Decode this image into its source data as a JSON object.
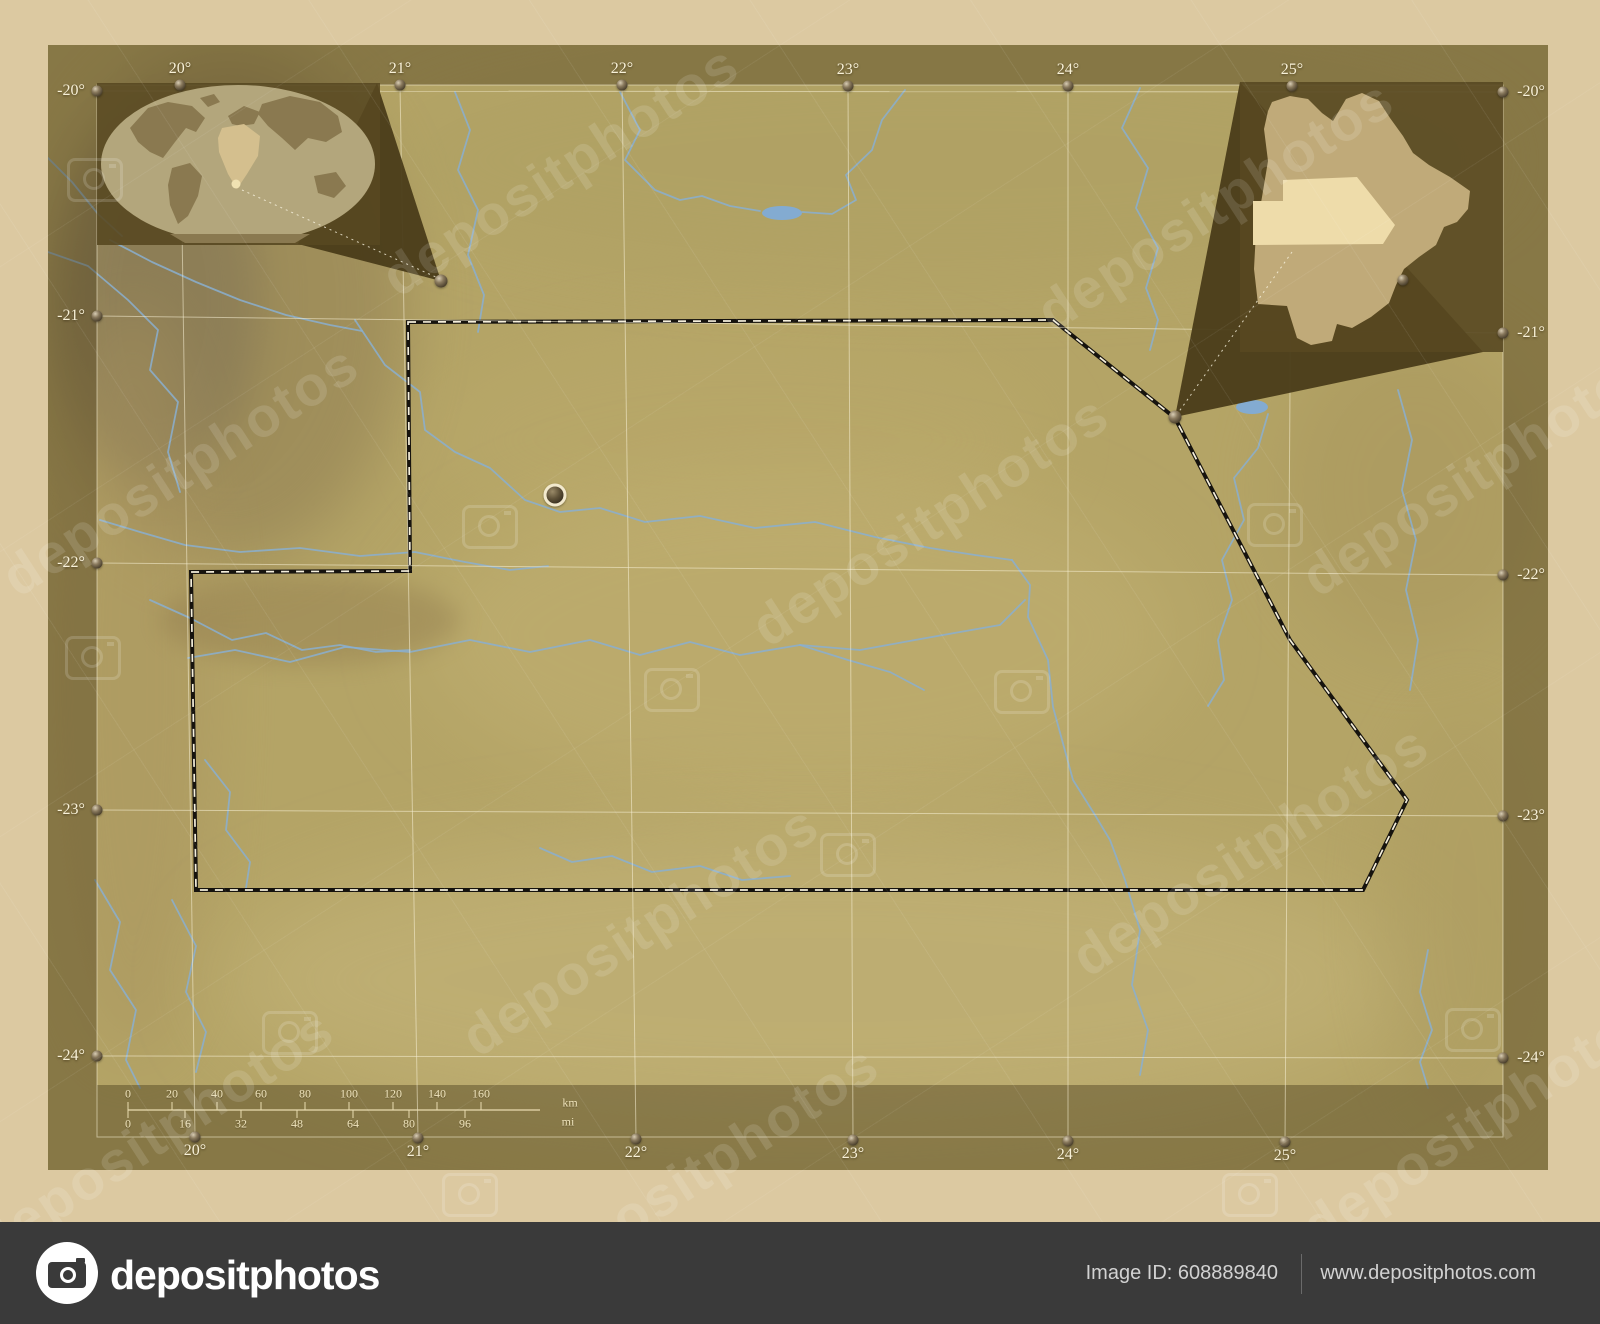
{
  "page": {
    "background": "#dcc9a1"
  },
  "footer": {
    "logo_text": "depositphotos",
    "image_id": "Image ID: 608889840",
    "website": "www.depositphotos.com"
  },
  "watermark": {
    "text": "depositphotos",
    "text_instances": [
      [
        560,
        170
      ],
      [
        1215,
        205
      ],
      [
        180,
        470
      ],
      [
        930,
        520
      ],
      [
        1480,
        470
      ],
      [
        640,
        930
      ],
      [
        1250,
        850
      ],
      [
        155,
        1135
      ],
      [
        700,
        1170
      ],
      [
        1480,
        1120
      ]
    ],
    "icon_instances": [
      [
        95,
        180
      ],
      [
        490,
        527
      ],
      [
        1275,
        525
      ],
      [
        93,
        658
      ],
      [
        672,
        690
      ],
      [
        1022,
        692
      ],
      [
        848,
        855
      ],
      [
        290,
        1033
      ],
      [
        1473,
        1030
      ],
      [
        470,
        1195
      ],
      [
        1250,
        1195
      ]
    ]
  },
  "axes": {
    "top": [
      {
        "label": "20°",
        "x": 180,
        "y": 85
      },
      {
        "label": "21°",
        "x": 400,
        "y": 85
      },
      {
        "label": "22°",
        "x": 622,
        "y": 85
      },
      {
        "label": "23°",
        "x": 848,
        "y": 86
      },
      {
        "label": "24°",
        "x": 1068,
        "y": 86
      },
      {
        "label": "25°",
        "x": 1292,
        "y": 86
      }
    ],
    "bottom": [
      {
        "label": "20°",
        "x": 195,
        "y": 1137
      },
      {
        "label": "21°",
        "x": 418,
        "y": 1138
      },
      {
        "label": "22°",
        "x": 636,
        "y": 1139
      },
      {
        "label": "23°",
        "x": 853,
        "y": 1140
      },
      {
        "label": "24°",
        "x": 1068,
        "y": 1141
      },
      {
        "label": "25°",
        "x": 1285,
        "y": 1142
      }
    ],
    "left": [
      {
        "label": "-20°",
        "x": 97,
        "y": 91
      },
      {
        "label": "-21°",
        "x": 97,
        "y": 316
      },
      {
        "label": "-22°",
        "x": 97,
        "y": 563
      },
      {
        "label": "-23°",
        "x": 97,
        "y": 810
      },
      {
        "label": "-24°",
        "x": 97,
        "y": 1056
      }
    ],
    "right": [
      {
        "label": "-20°",
        "x": 1503,
        "y": 92
      },
      {
        "label": "-21°",
        "x": 1503,
        "y": 333
      },
      {
        "label": "-22°",
        "x": 1503,
        "y": 575
      },
      {
        "label": "-23°",
        "x": 1503,
        "y": 816
      },
      {
        "label": "-24°",
        "x": 1503,
        "y": 1058
      }
    ]
  },
  "scalebar": {
    "km": {
      "unit": "km",
      "line_y": 1110,
      "line_x1": 128,
      "line_x2": 540,
      "label_y": 1094,
      "unit_x": 570,
      "unit_y": 1103,
      "ticks": [
        {
          "label": "0",
          "x": 128
        },
        {
          "label": "20",
          "x": 172
        },
        {
          "label": "40",
          "x": 217
        },
        {
          "label": "60",
          "x": 261
        },
        {
          "label": "80",
          "x": 305
        },
        {
          "label": "100",
          "x": 349
        },
        {
          "label": "120",
          "x": 393
        },
        {
          "label": "140",
          "x": 437
        },
        {
          "label": "160",
          "x": 481
        }
      ]
    },
    "mi": {
      "unit": "mi",
      "label_y": 1124,
      "unit_x": 568,
      "unit_y": 1122,
      "ticks": [
        {
          "label": "0",
          "x": 128
        },
        {
          "label": "16",
          "x": 185
        },
        {
          "label": "32",
          "x": 241
        },
        {
          "label": "48",
          "x": 297
        },
        {
          "label": "64",
          "x": 353
        },
        {
          "label": "80",
          "x": 409
        },
        {
          "label": "96",
          "x": 465
        }
      ]
    }
  },
  "map": {
    "photo": {
      "x": 48,
      "y": 45,
      "w": 1500,
      "h": 1125
    },
    "window": {
      "x": 97,
      "y": 85,
      "w": 1406,
      "h": 1052
    },
    "band": {
      "x": 97,
      "y": 1085,
      "w": 1406,
      "h": 52
    },
    "colors": {
      "terrain": "#b4a466",
      "margin_overlay": "rgba(74,60,26,0.42)",
      "band_fill": "rgba(62,50,20,0.40)",
      "grid": "rgba(247,240,214,0.55)",
      "river": "#8aafd0",
      "lake": "#83abd1",
      "boundary_dark": "#16130e",
      "boundary_light": "#f5efdc",
      "inset_panel": "rgba(88,72,33,0.90)",
      "globe_ocean": "#b3a67c",
      "globe_land": "#8a7950",
      "africa_highlight": "#d4bf8e",
      "country_fill": "#c0aa79",
      "district_highlight": "#eedcaa",
      "scale_line": "#e9dcb0"
    },
    "district": {
      "outline": [
        [
          408,
          322
        ],
        [
          1053,
          320
        ],
        [
          1175,
          418
        ],
        [
          1290,
          640
        ],
        [
          1407,
          800
        ],
        [
          1363,
          890
        ],
        [
          196,
          890
        ],
        [
          191,
          572
        ],
        [
          410,
          571
        ]
      ],
      "town": [
        555,
        495
      ]
    },
    "lakes": [
      {
        "cx": 782,
        "cy": 213,
        "rx": 20,
        "ry": 7
      },
      {
        "cx": 1252,
        "cy": 407,
        "rx": 16,
        "ry": 7
      }
    ],
    "rivers": [
      [
        [
          620,
          92
        ],
        [
          640,
          130
        ],
        [
          625,
          160
        ],
        [
          655,
          190
        ],
        [
          680,
          200
        ],
        [
          702,
          196
        ],
        [
          730,
          206
        ],
        [
          760,
          211
        ]
      ],
      [
        [
          905,
          90
        ],
        [
          882,
          120
        ],
        [
          872,
          150
        ],
        [
          846,
          175
        ],
        [
          856,
          200
        ],
        [
          832,
          214
        ],
        [
          802,
          212
        ]
      ],
      [
        [
          1140,
          88
        ],
        [
          1122,
          128
        ],
        [
          1148,
          168
        ],
        [
          1136,
          208
        ],
        [
          1158,
          248
        ],
        [
          1146,
          288
        ],
        [
          1158,
          320
        ],
        [
          1150,
          350
        ]
      ],
      [
        [
          48,
          158
        ],
        [
          72,
          182
        ],
        [
          98,
          214
        ],
        [
          122,
          236
        ]
      ],
      [
        [
          48,
          252
        ],
        [
          88,
          266
        ],
        [
          128,
          300
        ],
        [
          158,
          330
        ],
        [
          150,
          370
        ],
        [
          178,
          402
        ],
        [
          168,
          452
        ],
        [
          180,
          492
        ]
      ],
      [
        [
          110,
          240
        ],
        [
          152,
          262
        ],
        [
          196,
          282
        ],
        [
          240,
          300
        ],
        [
          286,
          315
        ],
        [
          330,
          325
        ],
        [
          362,
          331
        ]
      ],
      [
        [
          455,
          92
        ],
        [
          470,
          130
        ],
        [
          458,
          170
        ],
        [
          478,
          210
        ],
        [
          468,
          255
        ],
        [
          484,
          295
        ],
        [
          478,
          332
        ]
      ],
      [
        [
          355,
          320
        ],
        [
          385,
          365
        ],
        [
          420,
          392
        ],
        [
          425,
          430
        ],
        [
          455,
          452
        ],
        [
          490,
          468
        ],
        [
          525,
          500
        ],
        [
          560,
          512
        ],
        [
          600,
          508
        ],
        [
          645,
          522
        ],
        [
          700,
          516
        ],
        [
          755,
          528
        ],
        [
          815,
          522
        ],
        [
          875,
          537
        ],
        [
          930,
          548
        ],
        [
          975,
          555
        ],
        [
          1012,
          560
        ]
      ],
      [
        [
          188,
          658
        ],
        [
          235,
          650
        ],
        [
          290,
          662
        ],
        [
          345,
          647
        ],
        [
          410,
          652
        ],
        [
          470,
          640
        ],
        [
          530,
          652
        ],
        [
          590,
          640
        ],
        [
          640,
          655
        ],
        [
          690,
          642
        ],
        [
          740,
          655
        ],
        [
          800,
          645
        ],
        [
          860,
          650
        ],
        [
          915,
          640
        ],
        [
          960,
          632
        ],
        [
          1000,
          625
        ],
        [
          1025,
          600
        ]
      ],
      [
        [
          800,
          645
        ],
        [
          848,
          660
        ],
        [
          890,
          672
        ],
        [
          924,
          690
        ]
      ],
      [
        [
          1012,
          560
        ],
        [
          1030,
          585
        ],
        [
          1028,
          617
        ],
        [
          1048,
          660
        ],
        [
          1053,
          707
        ],
        [
          1073,
          780
        ],
        [
          1095,
          815
        ],
        [
          1110,
          840
        ],
        [
          1125,
          880
        ],
        [
          1140,
          930
        ],
        [
          1132,
          985
        ],
        [
          1148,
          1030
        ],
        [
          1140,
          1075
        ]
      ],
      [
        [
          100,
          520
        ],
        [
          140,
          532
        ],
        [
          185,
          545
        ],
        [
          240,
          552
        ],
        [
          300,
          548
        ],
        [
          360,
          556
        ],
        [
          415,
          552
        ],
        [
          465,
          562
        ],
        [
          510,
          570
        ],
        [
          548,
          566
        ]
      ],
      [
        [
          150,
          600
        ],
        [
          190,
          618
        ],
        [
          232,
          640
        ],
        [
          266,
          633
        ],
        [
          302,
          650
        ],
        [
          340,
          645
        ],
        [
          376,
          652
        ],
        [
          410,
          650
        ]
      ],
      [
        [
          1268,
          414
        ],
        [
          1258,
          448
        ],
        [
          1234,
          478
        ],
        [
          1244,
          520
        ],
        [
          1222,
          560
        ],
        [
          1232,
          600
        ],
        [
          1218,
          640
        ],
        [
          1224,
          680
        ],
        [
          1208,
          706
        ]
      ],
      [
        [
          1398,
          390
        ],
        [
          1412,
          440
        ],
        [
          1402,
          490
        ],
        [
          1416,
          540
        ],
        [
          1406,
          590
        ],
        [
          1418,
          640
        ],
        [
          1410,
          690
        ]
      ],
      [
        [
          1428,
          950
        ],
        [
          1420,
          992
        ],
        [
          1432,
          1030
        ],
        [
          1420,
          1062
        ],
        [
          1428,
          1088
        ]
      ],
      [
        [
          95,
          880
        ],
        [
          120,
          922
        ],
        [
          110,
          970
        ],
        [
          136,
          1010
        ],
        [
          126,
          1060
        ],
        [
          140,
          1088
        ]
      ],
      [
        [
          172,
          900
        ],
        [
          196,
          946
        ],
        [
          186,
          992
        ],
        [
          206,
          1032
        ],
        [
          196,
          1072
        ]
      ],
      [
        [
          540,
          848
        ],
        [
          572,
          862
        ],
        [
          612,
          856
        ],
        [
          652,
          872
        ],
        [
          700,
          866
        ],
        [
          742,
          880
        ],
        [
          790,
          876
        ]
      ],
      [
        [
          205,
          760
        ],
        [
          230,
          792
        ],
        [
          226,
          830
        ],
        [
          250,
          862
        ],
        [
          246,
          888
        ]
      ]
    ],
    "insets": {
      "world": {
        "panel": {
          "x": 97,
          "y": 83,
          "w": 283,
          "h": 162
        },
        "tail": [
          [
            377,
            83
          ],
          [
            441,
            281
          ],
          [
            298,
            244
          ]
        ],
        "pin": [
          441,
          281
        ],
        "leader": [
          [
            242,
            190
          ],
          [
            438,
            278
          ]
        ],
        "globe": {
          "cx": 238,
          "cy": 164,
          "rx": 137,
          "ry": 79
        },
        "continents": [
          "130,128 148,108 168,102 192,106 205,118 196,132 186,128 175,142 163,158 150,152 138,142",
          "172,168 190,163 202,176 198,196 188,216 178,224 170,205 168,185",
          "200,98 214,94 220,102 208,107",
          "228,116 244,106 260,112 254,124 240,126 232,124",
          "262,104 290,96 320,102 338,116 342,132 326,142 308,138 295,150 282,138 268,126 258,114",
          "314,176 336,172 346,186 334,198 318,193",
          "170,234 310,234 295,243 185,243"
        ],
        "africa": "222,128 244,124 260,136 258,156 247,174 237,189 228,174 219,152 218,138",
        "highlight_dot": [
          236,
          184
        ]
      },
      "botswana": {
        "panel": {
          "x": 1240,
          "y": 82,
          "w": 263,
          "h": 270
        },
        "tail": [
          [
            1240,
            82
          ],
          [
            1175,
            417
          ],
          [
            1483,
            352
          ]
        ],
        "pin": [
          1175,
          417
        ],
        "leader": [
          [
            1292,
            252
          ],
          [
            1178,
            413
          ]
        ],
        "country": "1272,102 1290,96 1308,99 1322,113 1333,121 1346,99 1362,93 1379,101 1390,118 1403,136 1413,153 1429,165 1450,177 1470,191 1468,209 1457,222 1444,227 1436,245 1419,257 1404,269 1396,285 1389,303 1371,317 1352,328 1337,324 1332,341 1311,345 1297,338 1292,322 1287,306 1258,304 1254,269 1256,231 1262,197 1268,161 1264,129 1268,111",
        "district": "1283,180 1357,177 1395,225 1383,244 1253,245 1253,201 1283,201",
        "marker": [
          1403,
          280
        ]
      }
    }
  }
}
